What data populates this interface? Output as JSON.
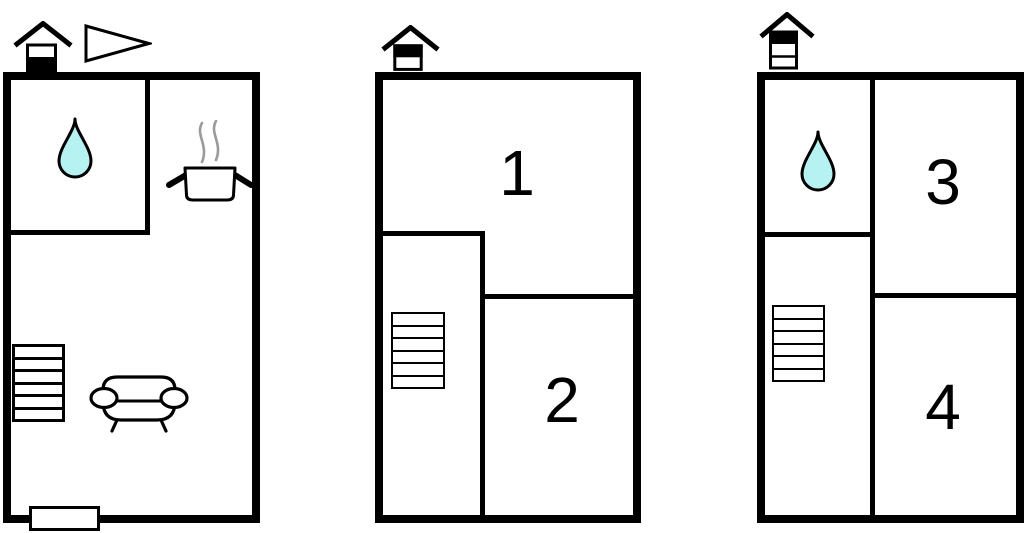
{
  "colors": {
    "wall": "#000000",
    "water_drop_fill": "#b6f2f1",
    "steam": "#9a9a9a"
  },
  "plans": [
    {
      "name": "ground-floor-plan",
      "level_indicator": {
        "floors": 2,
        "filled": "bottom"
      },
      "symbols": [
        "house-level-icon",
        "pennant-icon",
        "water-drop-icon",
        "cooking-pot-icon",
        "stairs-icon",
        "sofa-icon",
        "entrance-icon"
      ],
      "rooms": []
    },
    {
      "name": "middle-floor-plan",
      "level_indicator": {
        "floors": 2,
        "filled": "top"
      },
      "symbols": [
        "house-level-icon",
        "stairs-icon"
      ],
      "rooms": [
        {
          "label": "1"
        },
        {
          "label": "2"
        }
      ]
    },
    {
      "name": "top-floor-plan",
      "level_indicator": {
        "floors": 3,
        "filled": "top"
      },
      "symbols": [
        "house-level-icon",
        "water-drop-icon",
        "stairs-icon"
      ],
      "rooms": [
        {
          "label": "3"
        },
        {
          "label": "4"
        }
      ]
    }
  ]
}
